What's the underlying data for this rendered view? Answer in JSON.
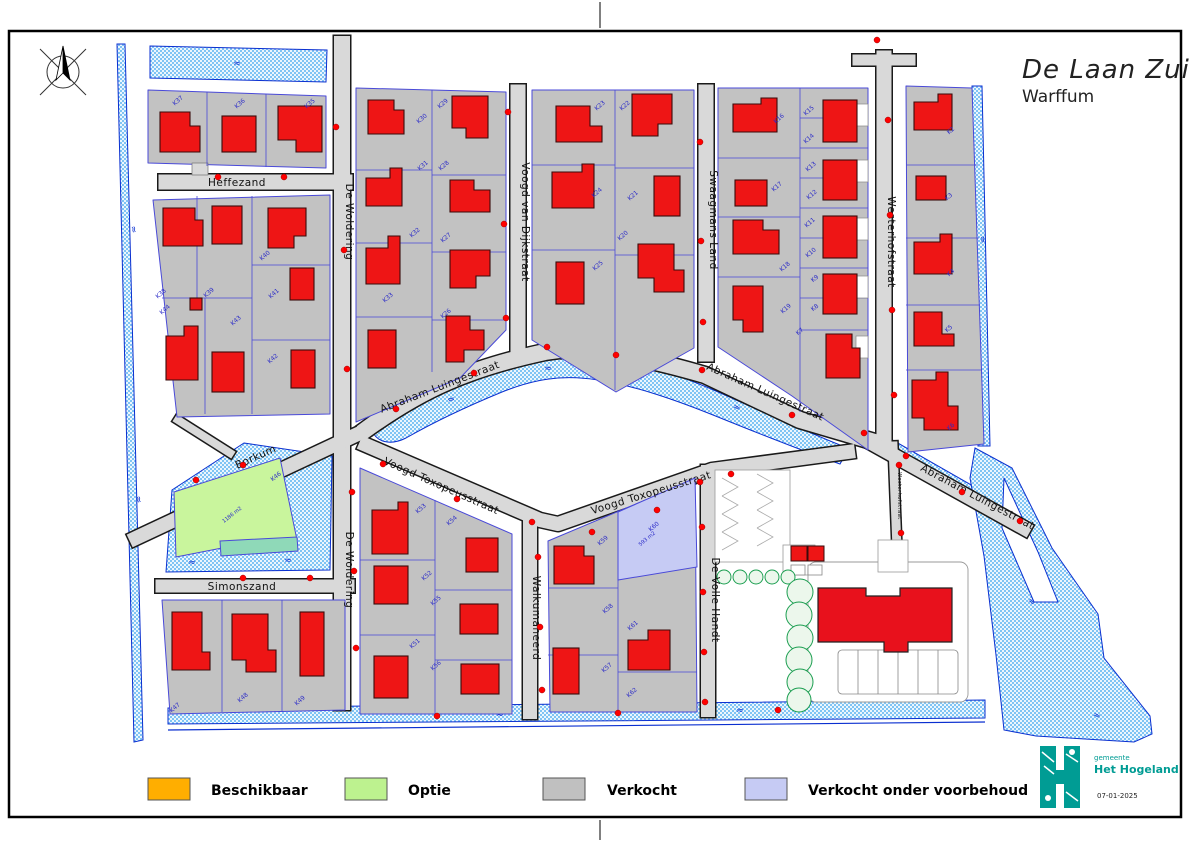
{
  "page": {
    "title": "De Laan Zuid",
    "subtitle": "Warffum"
  },
  "legend": {
    "items": [
      {
        "label": "Beschikbaar",
        "color": "#FFAE00"
      },
      {
        "label": "Optie",
        "color": "#BDF28F"
      },
      {
        "label": "Verkocht",
        "color": "#C0C0C0"
      },
      {
        "label": "Verkocht onder voorbehoud",
        "color": "#C6CBF4"
      }
    ]
  },
  "stamp": {
    "gemeente": "gemeente",
    "name": "Het Hogeland",
    "date": "07-01-2025"
  },
  "streets": {
    "heffezand": "Heffezand",
    "de_woldering": "De Woldering",
    "voogd_van_dijkstraat": "Voogd van Dijkstraat",
    "swaagmans_land": "Swaagmans Land",
    "westerhofstraat": "Westerhofstraat",
    "abraham_luingestraat": "Abraham Luingestraat",
    "voogd_toxopeusstraat": "Voogd Toxopeusstraat",
    "borkum": "Borkum",
    "simonszand": "Simonszand",
    "walkumaheerd": "Walkumaheerd",
    "de_volle_handt": "De Volle Handt"
  },
  "plots": {
    "k2": "K2",
    "k3": "K3",
    "k4": "K4",
    "k5": "K5",
    "k6": "K6",
    "k7": "K7",
    "k8": "K8",
    "k9": "K9",
    "k10": "K10",
    "k11": "K11",
    "k12": "K12",
    "k13": "K13",
    "k14": "K14",
    "k15": "K15",
    "k16": "K16",
    "k17": "K17",
    "k18": "K18",
    "k19": "K19",
    "k20": "K20",
    "k21": "K21",
    "k22": "K22",
    "k23": "K23",
    "k24": "K24",
    "k25": "K25",
    "k26": "K26",
    "k27": "K27",
    "k28": "K28",
    "k29": "K29",
    "k30": "K30",
    "k31": "K31",
    "k32": "K32",
    "k33": "K33",
    "k35": "K35",
    "k36": "K36",
    "k37": "K37",
    "k38": "K38",
    "k39": "K39",
    "k40": "K40",
    "k41": "K41",
    "k42": "K42",
    "k43": "K43",
    "k44": "K44",
    "k46": "K46",
    "k47": "K47",
    "k48": "K48",
    "k49": "K49",
    "k51": "K51",
    "k52": "K52",
    "k53": "K53",
    "k54": "K54",
    "k55": "K55",
    "k56": "K56",
    "k57": "K57",
    "k58": "K58",
    "k59": "K59",
    "k60": "K60",
    "k61": "K61",
    "k62": "K62"
  },
  "areas": {
    "k46": "1186 m2",
    "k60": "593 m2"
  },
  "water_symbol": "≈"
}
